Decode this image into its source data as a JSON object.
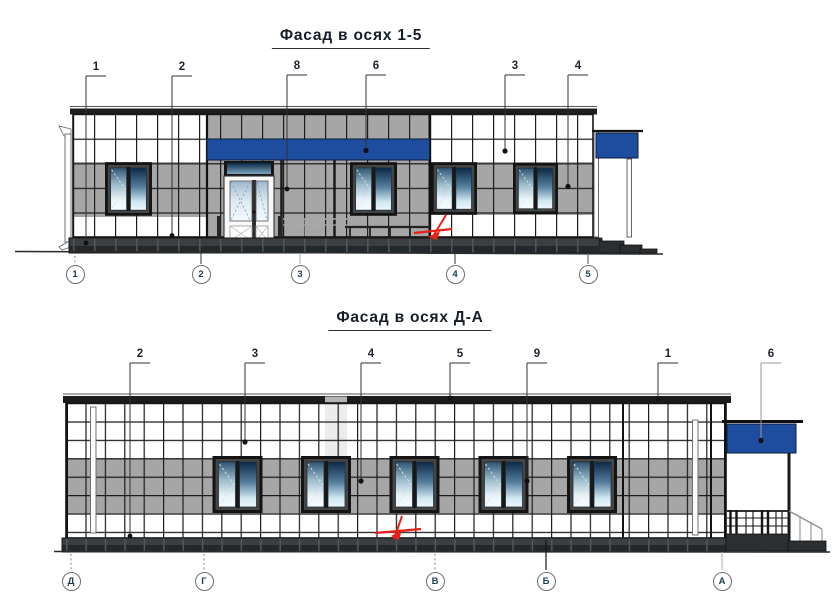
{
  "drawing": {
    "facade_top": {
      "title": "Фасад в осях 1-5",
      "callouts": [
        "1",
        "2",
        "8",
        "6",
        "3",
        "4"
      ],
      "axis_marks": [
        "1",
        "2",
        "3",
        "4",
        "5"
      ]
    },
    "facade_bottom": {
      "title": "Фасад в осях Д-А",
      "callouts": [
        "2",
        "3",
        "4",
        "5",
        "9",
        "1",
        "6"
      ],
      "axis_marks": [
        "Д",
        "Г",
        "В",
        "Б",
        "А"
      ]
    },
    "colors": {
      "sign_blue": "#1e4c9e",
      "panel_gray": "#a6a6a6",
      "panel_white": "#ffffff",
      "frame_dark": "#1b1b1b",
      "plinth_dark": "#2c2f31",
      "marker_red": "#e8211a",
      "annotation": "#333333"
    }
  }
}
